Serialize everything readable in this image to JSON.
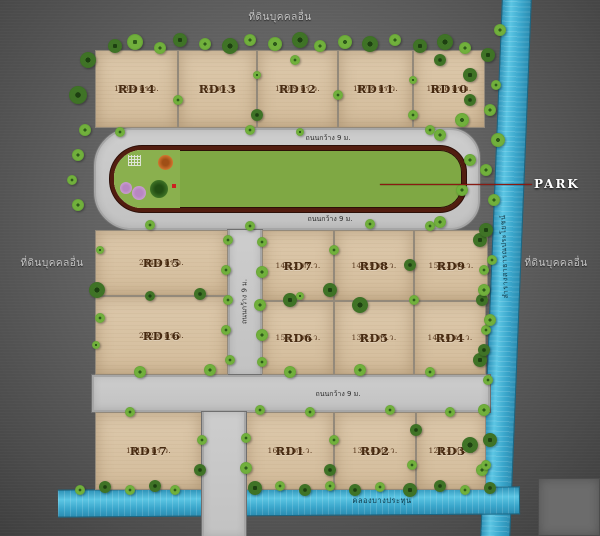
{
  "plots": [
    {
      "id": "RD14",
      "area": "153.4 ตร.ว."
    },
    {
      "id": "RD13",
      "area": "154 ตร.ว."
    },
    {
      "id": "RD12",
      "area": "150.9 ตร.ว."
    },
    {
      "id": "RD11",
      "area": "147.8 ตร.ว."
    },
    {
      "id": "RD10",
      "area": "156.8 ตร.ว."
    },
    {
      "id": "RD15",
      "area": "234.4 ตร.ว."
    },
    {
      "id": "RD16",
      "area": "222.6 ตร.ว."
    },
    {
      "id": "RD7",
      "area": "145.2 ตร.ว."
    },
    {
      "id": "RD8",
      "area": "143.9 ตร.ว."
    },
    {
      "id": "RD9",
      "area": "151.3 ตร.ว."
    },
    {
      "id": "RD6",
      "area": "155.7 ตร.ว."
    },
    {
      "id": "RD5",
      "area": "137.4 ตร.ว."
    },
    {
      "id": "RD4",
      "area": "140.6 ตร.ว."
    },
    {
      "id": "RD17",
      "area": "191.4 ตร.ว."
    },
    {
      "id": "RD1",
      "area": "165.3 ตร.ว."
    },
    {
      "id": "RD2",
      "area": "130.6 ตร.ว."
    },
    {
      "id": "RD3",
      "area": "124.4 ตร.ว."
    }
  ],
  "labels": {
    "adjacent_top": "ที่ดินบุคคลอื่น",
    "adjacent_left": "ที่ดินบุคคลอื่น",
    "adjacent_right": "ที่ดินบุคคลอื่น",
    "park": "PARK",
    "canal_right": "ลำรางสาธารณประโยชน์",
    "canal_bottom": "คลองบางประทุน",
    "road_width": "ถนนกว้าง 9 ม."
  },
  "colors": {
    "background": "#616161",
    "plot_fill": "#d8c2a4",
    "road": "#c8c8c8",
    "canal": "#45b0d5",
    "park_border": "#521d10",
    "lawn": "#7fa844",
    "plot_text": "#44280f",
    "edge_label": "#c6c6c6",
    "park_label_color": "#ffffff",
    "leader_line": "#8a1a12"
  }
}
